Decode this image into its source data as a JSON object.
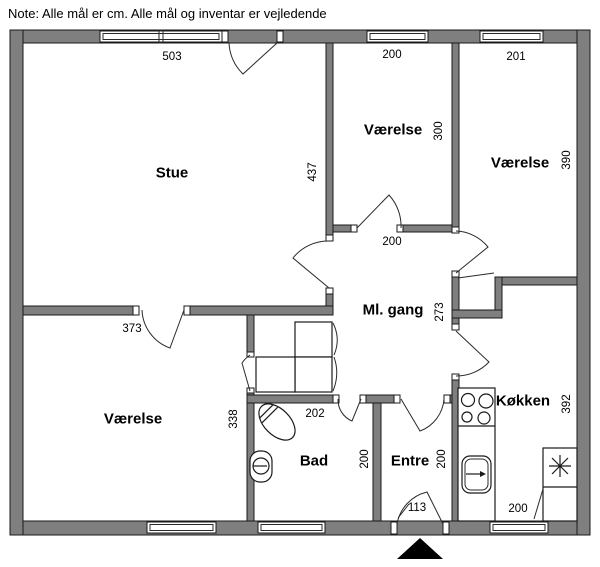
{
  "note": "Note: Alle mål er cm. Alle mål og inventar er vejledende",
  "colors": {
    "wall_fill": "#7f7f7f",
    "outline": "#1a1a1a",
    "background": "#ffffff"
  },
  "rooms": {
    "stue": {
      "label": "Stue",
      "width_cm": "503",
      "height_cm": "437"
    },
    "vaerelse_mid": {
      "label": "Værelse",
      "width_cm": "200",
      "height_cm": "300"
    },
    "vaerelse_right": {
      "label": "Værelse",
      "width_cm": "201",
      "height_cm": "390"
    },
    "ml_gang": {
      "label": "Ml. gang",
      "width_cm": "200",
      "height_cm": "273"
    },
    "vaerelse_bottom": {
      "label": "Værelse",
      "width_cm": "373",
      "height_cm": "338"
    },
    "bad": {
      "label": "Bad",
      "width_cm": "202",
      "height_cm": "200"
    },
    "entre": {
      "label": "Entre",
      "width_cm": "113",
      "height_cm": "200"
    },
    "koekken": {
      "label": "Køkken",
      "width_cm": "200",
      "height_cm": "392"
    }
  }
}
